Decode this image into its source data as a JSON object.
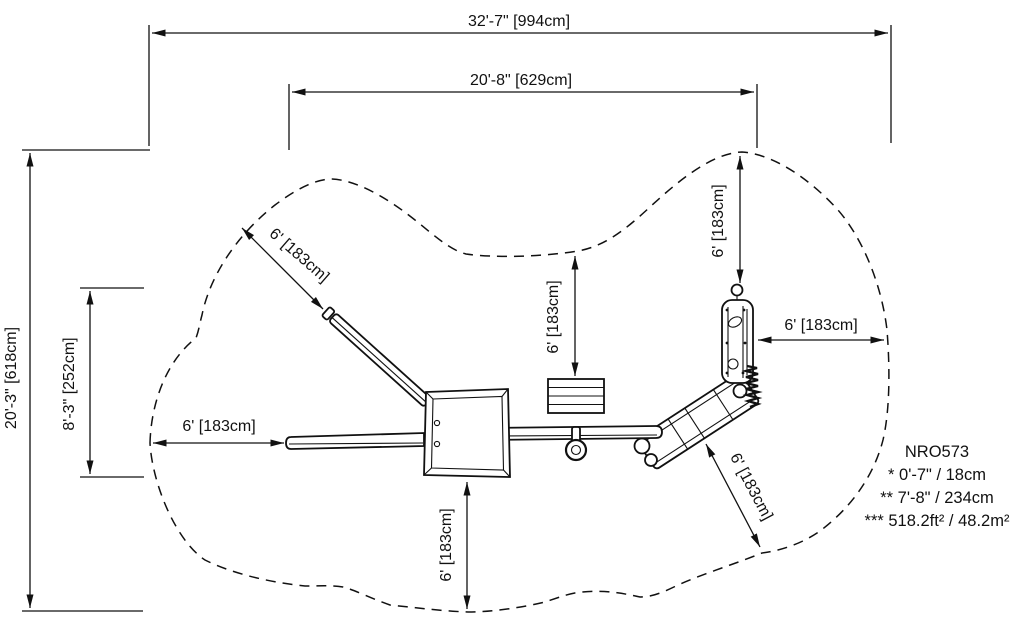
{
  "labels": {
    "overall_width": "32'-7\" [994cm]",
    "inner_width": "20'-8\" [629cm]",
    "overall_height": "20'-3\" [618cm]",
    "offset_height": "8'-3\" [252cm]",
    "clearance": "6' [183cm]"
  },
  "notes": {
    "model": "NRO573",
    "line1": "*  0'-7\" / 18cm",
    "line2": "**  7'-8\" / 234cm",
    "line3": "***  518.2ft² / 48.2m²"
  },
  "colors": {
    "ink": "#111111",
    "background": "#ffffff"
  }
}
